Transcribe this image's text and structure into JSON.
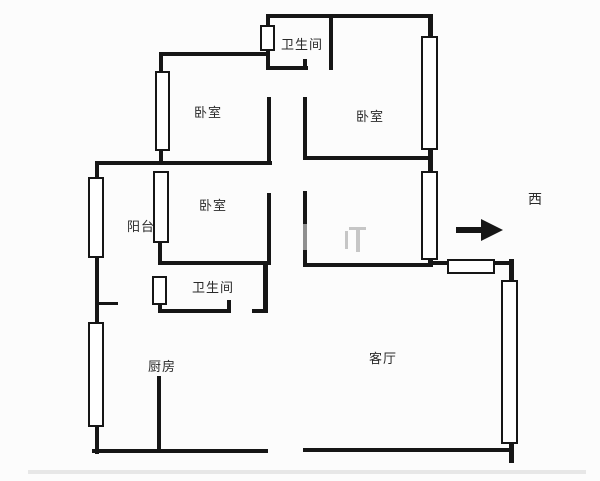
{
  "plan": {
    "type": "apartment-floorplan",
    "colors": {
      "background": "#fcfcfc",
      "wall": "#161616",
      "label": "#2a2a2a",
      "door_gray": "#8f8f8f",
      "faint_mark": "#c6c6c6",
      "bottom_band": "#e7e7e7"
    },
    "rooms": [
      {
        "id": "bathroom-top",
        "label": "卫生间"
      },
      {
        "id": "bedroom-top-left",
        "label": "卧室"
      },
      {
        "id": "bedroom-top-right",
        "label": "卧室"
      },
      {
        "id": "bedroom-middle",
        "label": "卧室"
      },
      {
        "id": "balcony",
        "label": "阳台"
      },
      {
        "id": "bathroom-middle",
        "label": "卫生间"
      },
      {
        "id": "kitchen",
        "label": "厨房"
      },
      {
        "id": "living-room",
        "label": "客厅"
      }
    ],
    "compass": {
      "label": "西",
      "arrow_direction": "right"
    }
  }
}
